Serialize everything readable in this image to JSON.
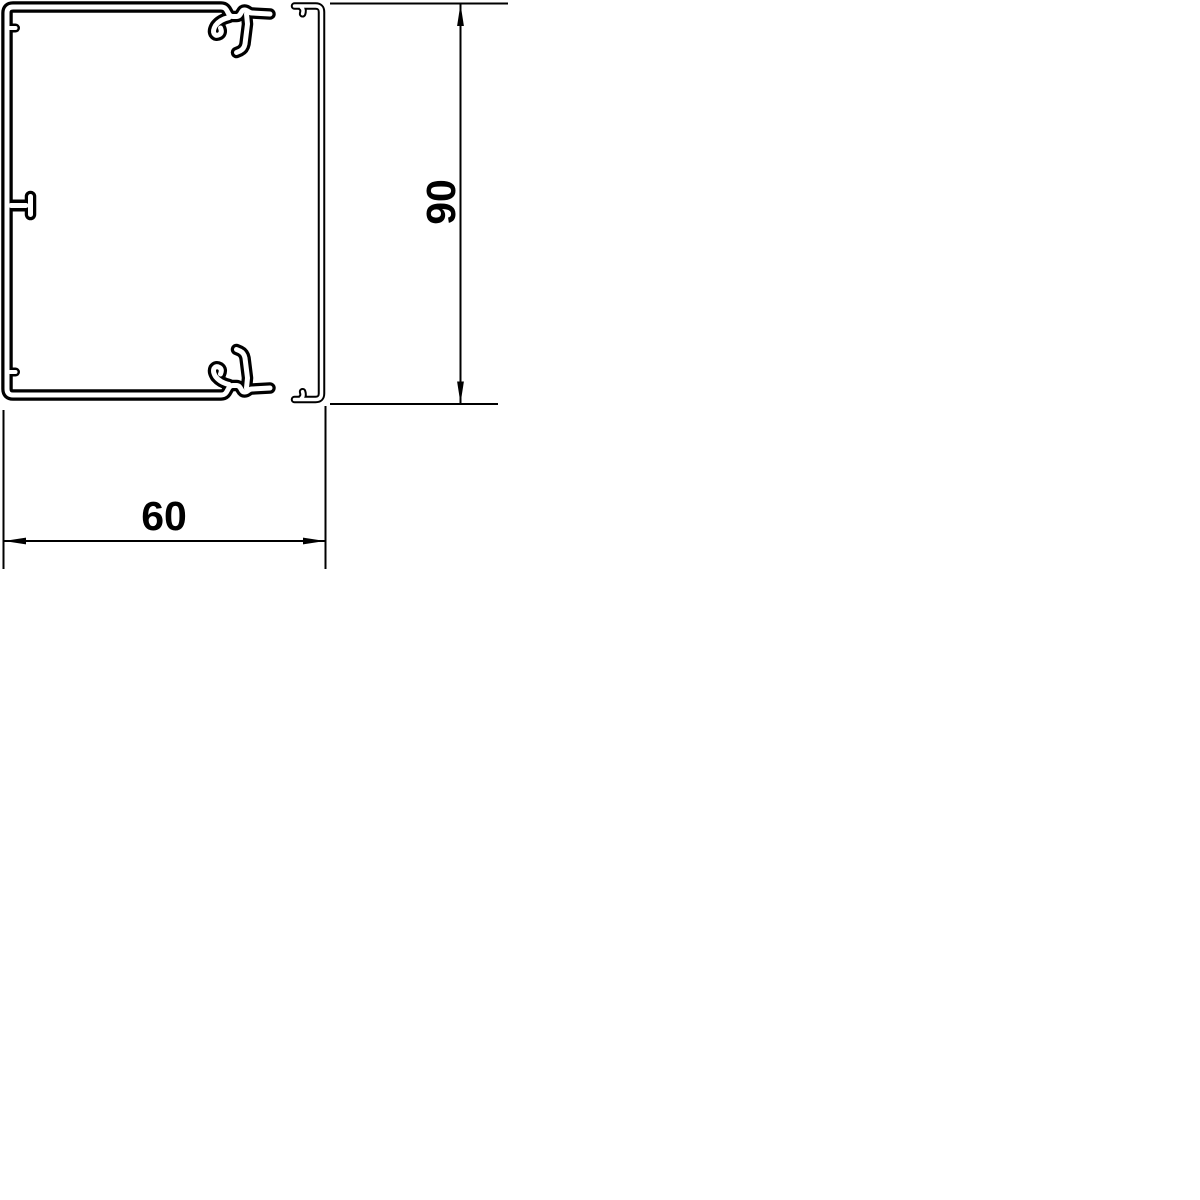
{
  "canvas": {
    "background": "#ffffff",
    "line_color": "#000000"
  },
  "drawing": {
    "components": {
      "base": "trunking-base-profile",
      "cover": "cover-profile"
    },
    "dimensions": {
      "width": {
        "label": "60",
        "orientation": "horizontal"
      },
      "height": {
        "label": "90",
        "orientation": "vertical"
      }
    }
  }
}
